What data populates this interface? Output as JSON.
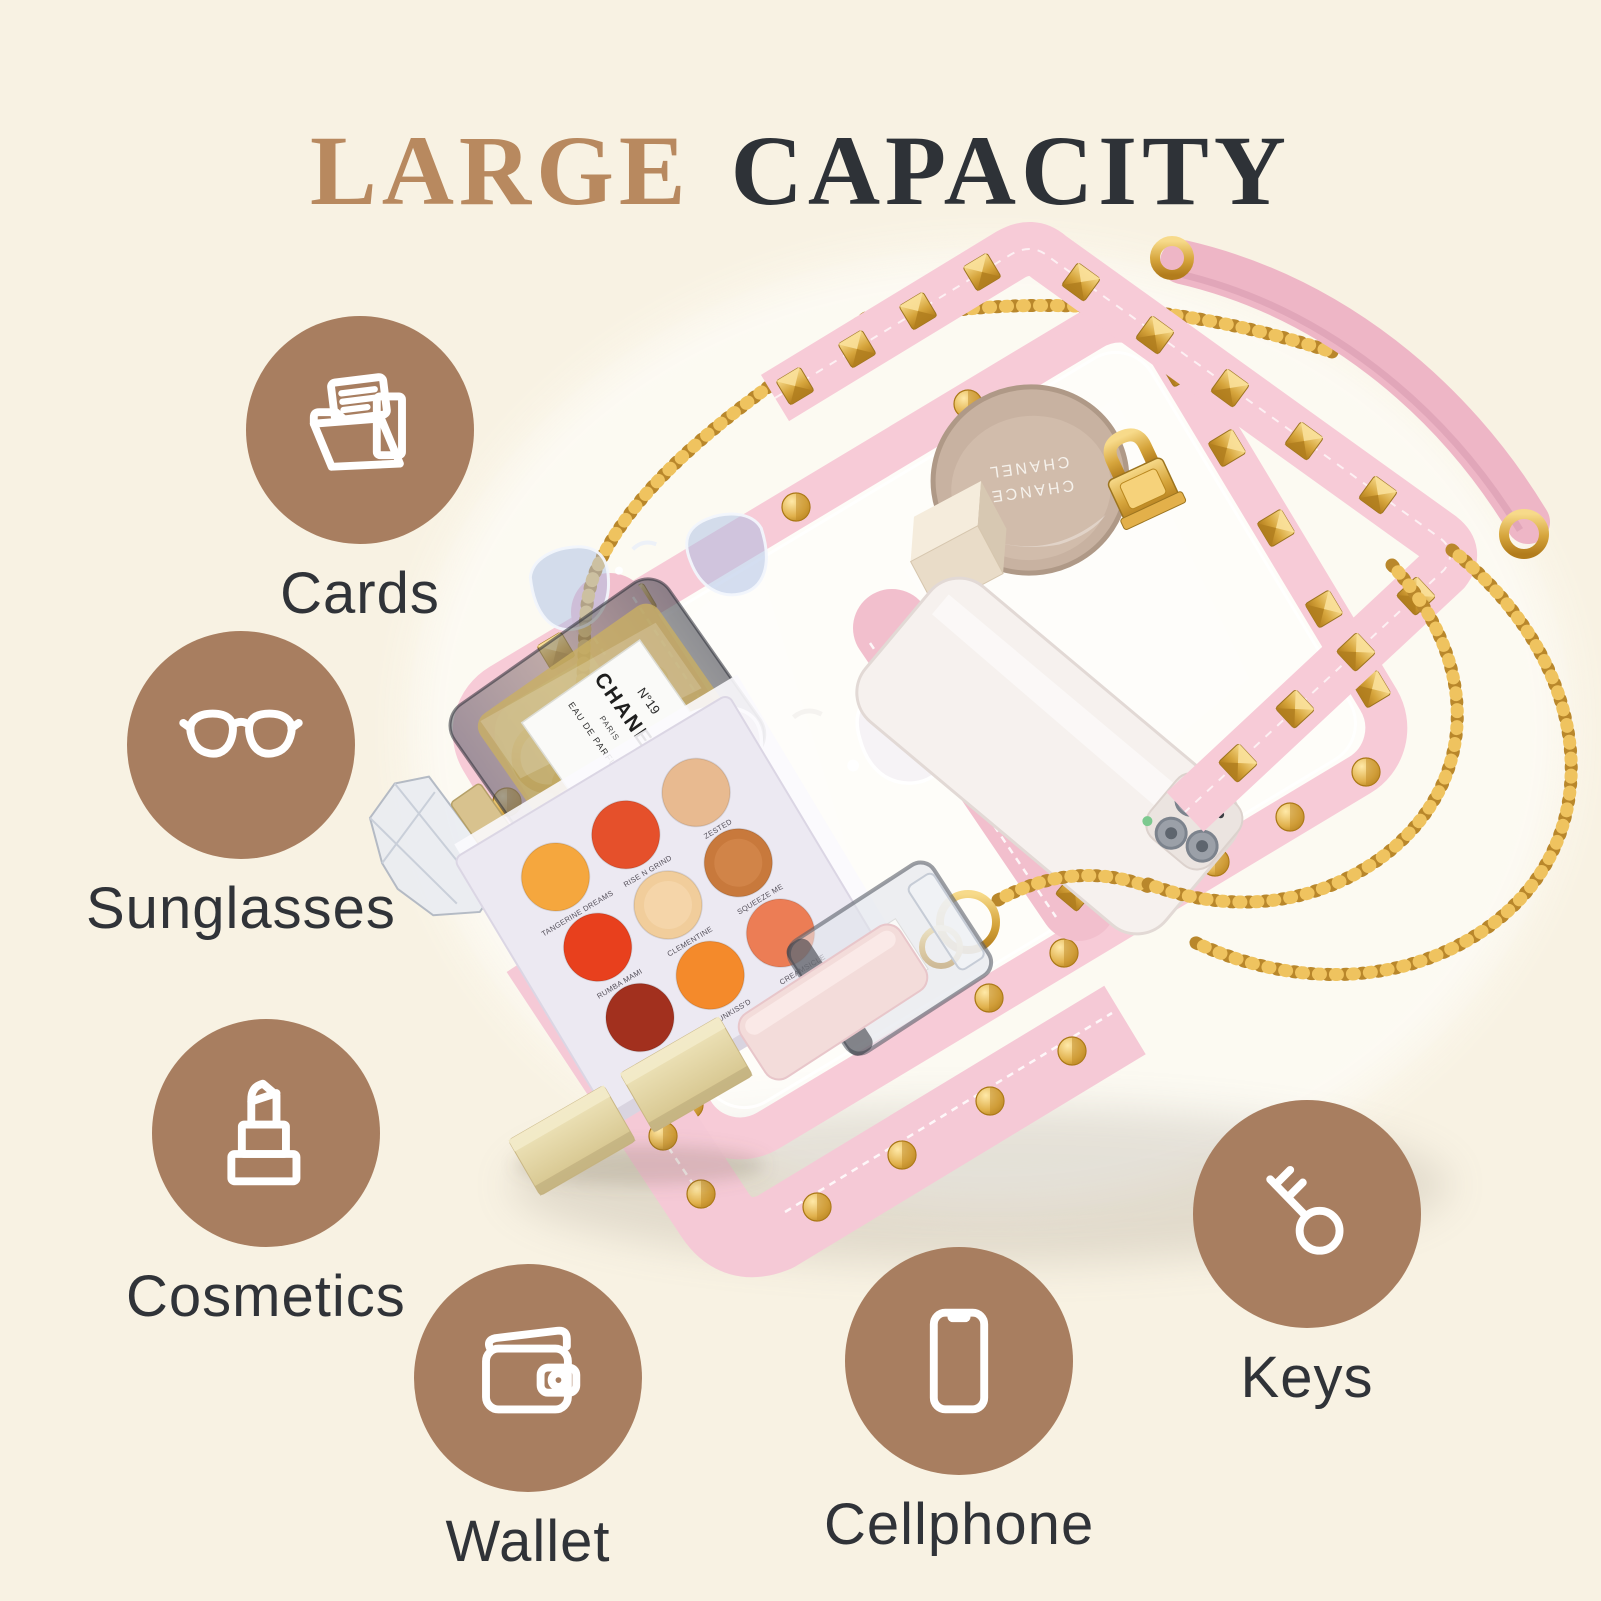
{
  "colors": {
    "background": "#F8F2E3",
    "badge_brown": "#A87E60",
    "title_tan": "#B8895F",
    "title_dark": "#2E3237",
    "label_dark": "#303338",
    "bag_pink": "#F7CBD7",
    "strap_pink": "#EEB6C6",
    "gold": "#D8A93F",
    "icon_white": "#FFFFFF"
  },
  "title": {
    "primary": "LARGE",
    "secondary": "CAPACITY"
  },
  "features": [
    {
      "label": "Cards",
      "icon": "folder-cards-icon"
    },
    {
      "label": "Sunglasses",
      "icon": "sunglasses-icon"
    },
    {
      "label": "Cosmetics",
      "icon": "lipstick-icon"
    },
    {
      "label": "Wallet",
      "icon": "wallet-icon"
    },
    {
      "label": "Cellphone",
      "icon": "smartphone-icon"
    },
    {
      "label": "Keys",
      "icon": "key-icon"
    }
  ],
  "product": {
    "compact": {
      "line1": "CHANCE",
      "line2": "CHANEL"
    },
    "perfume": {
      "line1": "N°19",
      "line2": "CHANEL",
      "line3": "PARIS",
      "line4": "EAU DE PARFUM"
    },
    "small_perfume": {
      "line1": "N°19",
      "line2": "CHANEL"
    },
    "palette": {
      "shades": [
        {
          "name": "TANGERINE DREAMS",
          "color": "#F5A73E"
        },
        {
          "name": "RISE N GRIND",
          "color": "#E5502B"
        },
        {
          "name": "ZESTED",
          "color": "#E8BA90"
        },
        {
          "name": "RUMBA MAMI",
          "color": "#E8401D"
        },
        {
          "name": "CLEMENTINE",
          "color": "#F1CD9B"
        },
        {
          "name": "SQUEEZE ME",
          "color": "#C8793C"
        },
        {
          "name": "TA PEEL ME?",
          "color": "#A2301E"
        },
        {
          "name": "SUNKISS'D",
          "color": "#F48A2B"
        },
        {
          "name": "CREAMSICLE",
          "color": "#EC7D55"
        }
      ]
    }
  }
}
